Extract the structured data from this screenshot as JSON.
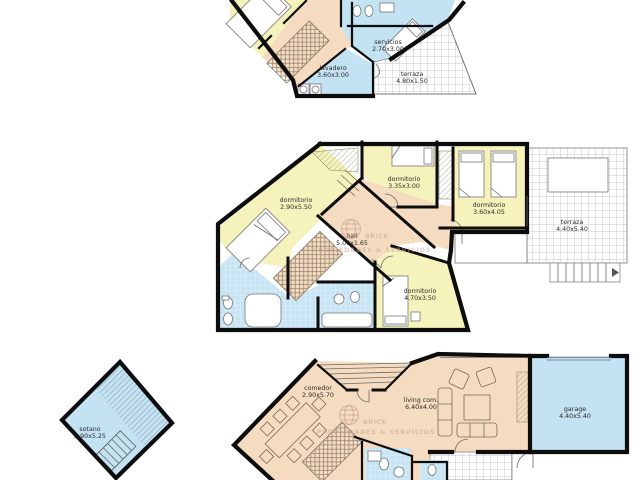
{
  "watermark": {
    "brand": "BRICK",
    "tagline": "PROPIEDADES & SERVICIOS"
  },
  "plans": {
    "top": {
      "rooms": [
        {
          "name": "servicios",
          "size": "2.70x3.00"
        },
        {
          "name": "lavadero",
          "size": "3.60x3.00"
        },
        {
          "name": "terraza",
          "size": "4.80x1.50"
        }
      ]
    },
    "middle": {
      "rooms": [
        {
          "name": "dormitorio",
          "size": "2.90x5.50"
        },
        {
          "name": "dormitorio",
          "size": "3.35x3.00"
        },
        {
          "name": "dormitorio",
          "size": "3.60x4.05"
        },
        {
          "name": "hall",
          "size": "5.00x1.65"
        },
        {
          "name": "dormitorio",
          "size": "4.70x3.50"
        },
        {
          "name": "terraza",
          "size": "4.40x5.40"
        }
      ]
    },
    "bottom": {
      "rooms": [
        {
          "name": "sotano",
          "size": "2.90x5.25"
        },
        {
          "name": "comedor",
          "size": "2.90x5.70"
        },
        {
          "name": "living com.",
          "size": "6.40x4.00"
        },
        {
          "name": "garage",
          "size": "4.40x5.40"
        }
      ]
    }
  },
  "colors": {
    "room_yellow": "#F6F2BB",
    "room_salmon": "#F5DCC1",
    "room_blue": "#C3E2F2",
    "wall": "#0D0D0D",
    "watermark": "#C79E93",
    "grid": "#B5B5B5"
  }
}
